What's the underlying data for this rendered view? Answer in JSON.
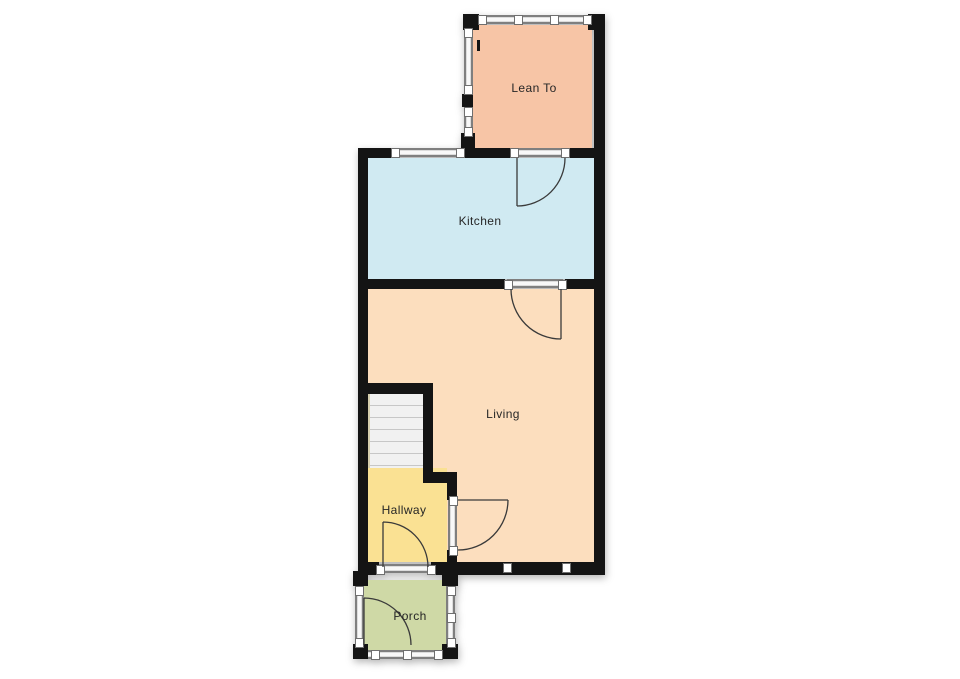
{
  "plan": {
    "type": "residential-floor-plan",
    "rooms": [
      {
        "id": "lean-to",
        "label": "Lean To",
        "color": "#f7c5a6"
      },
      {
        "id": "kitchen",
        "label": "Kitchen",
        "color": "#d0eaf2"
      },
      {
        "id": "living",
        "label": "Living",
        "color": "#fcdebe"
      },
      {
        "id": "hallway",
        "label": "Hallway",
        "color": "#fae193"
      },
      {
        "id": "porch",
        "label": "Porch",
        "color": "#cfd9a6"
      }
    ],
    "colors": {
      "wall": "#141414",
      "window_frame": "#7f7f7f",
      "window_fill": "#f8f8f8",
      "stairs_fill": "#f1f1f1",
      "stair_tread_line": "#c7c7c7",
      "door_stroke": "#3a3a3a",
      "background": "#ffffff"
    },
    "features": {
      "doors": [
        "lean-to-to-kitchen",
        "kitchen-to-living",
        "hallway-to-living",
        "porch-to-hallway",
        "front-door-porch"
      ],
      "windows": [
        "lean-to-top-glazing",
        "lean-to-left-glazing",
        "kitchen-top-window",
        "living-bottom-window",
        "porch-glazing"
      ],
      "stairs": "staircase-left-of-living"
    }
  }
}
